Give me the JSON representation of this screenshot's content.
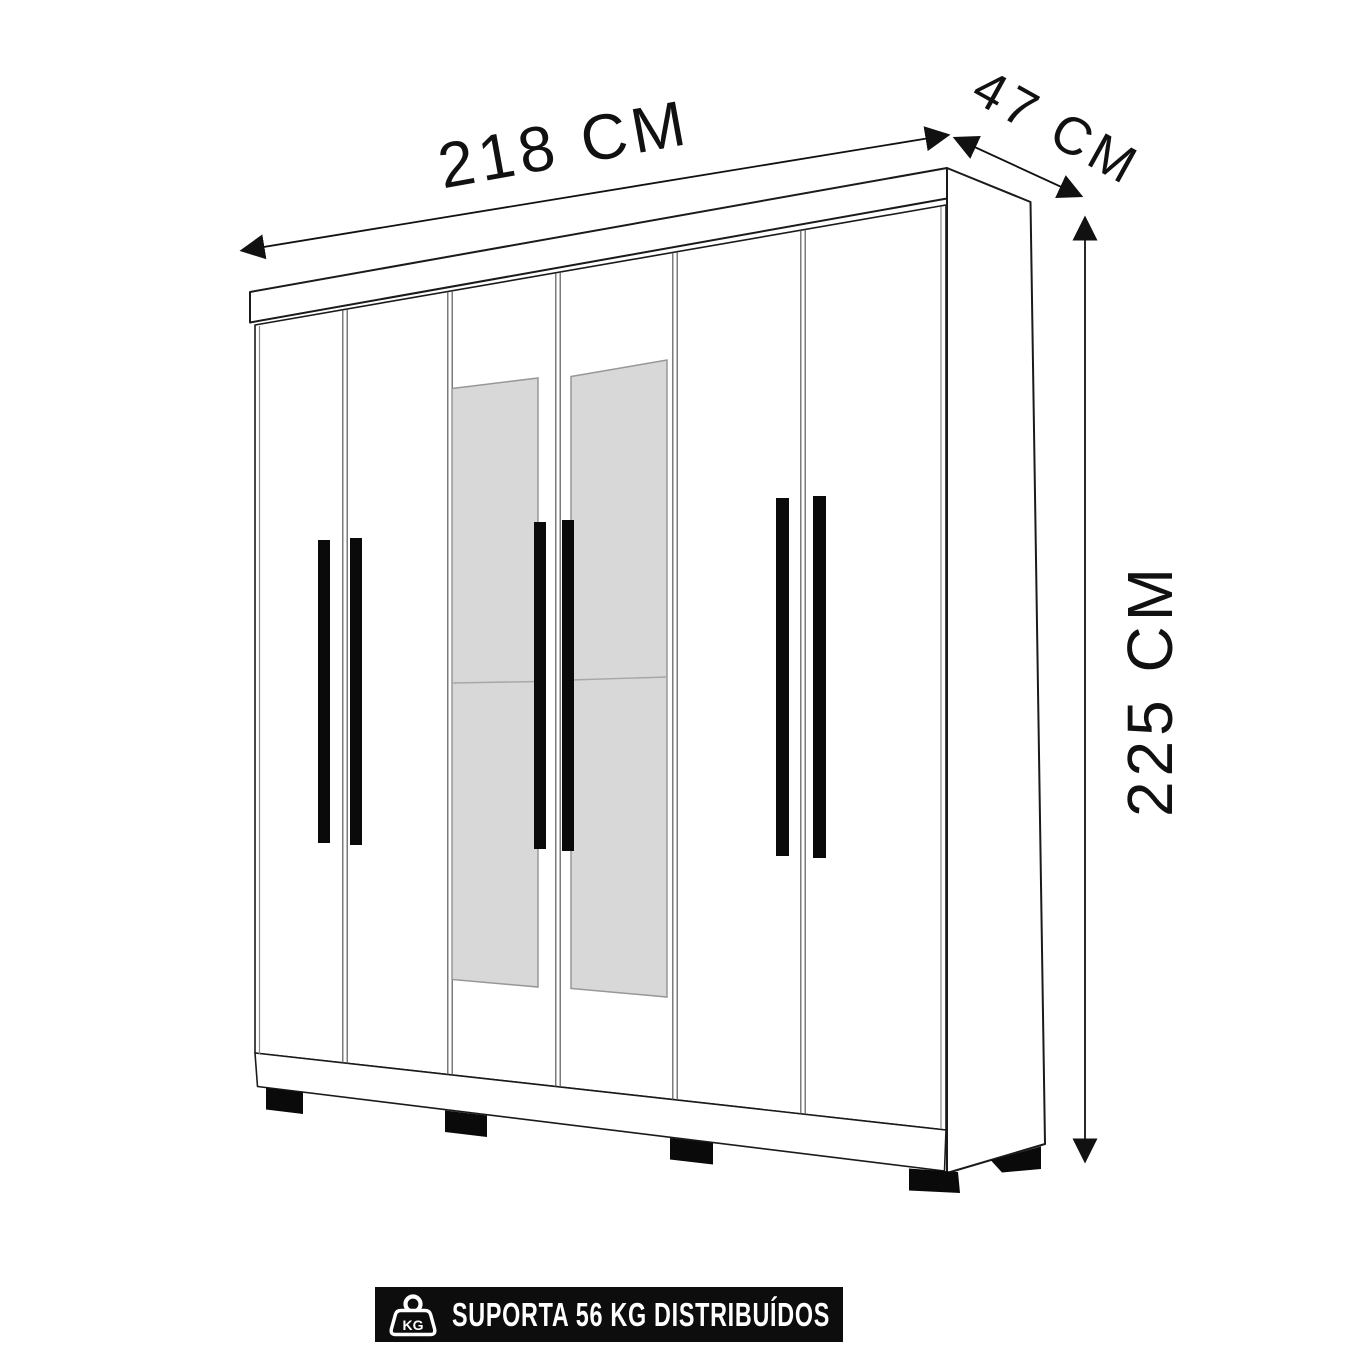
{
  "dimensions": {
    "width": "218 CM",
    "depth": "47 CM",
    "height": "225 CM"
  },
  "banner": {
    "text": "SUPORTA 56 KG DISTRIBUÍDOS",
    "icon_text": "KG",
    "background": "#0d0d0d",
    "text_color": "#ffffff"
  },
  "wardrobe": {
    "description": "Line drawing of a 6-door wardrobe in perspective with 2 central mirrored doors, 6 vertical black handles and black feet",
    "door_count": 6,
    "mirror_count": 2,
    "mirror_color": "#d8d8d8",
    "outline_color": "#1a1a1a",
    "body_color": "#ffffff"
  }
}
